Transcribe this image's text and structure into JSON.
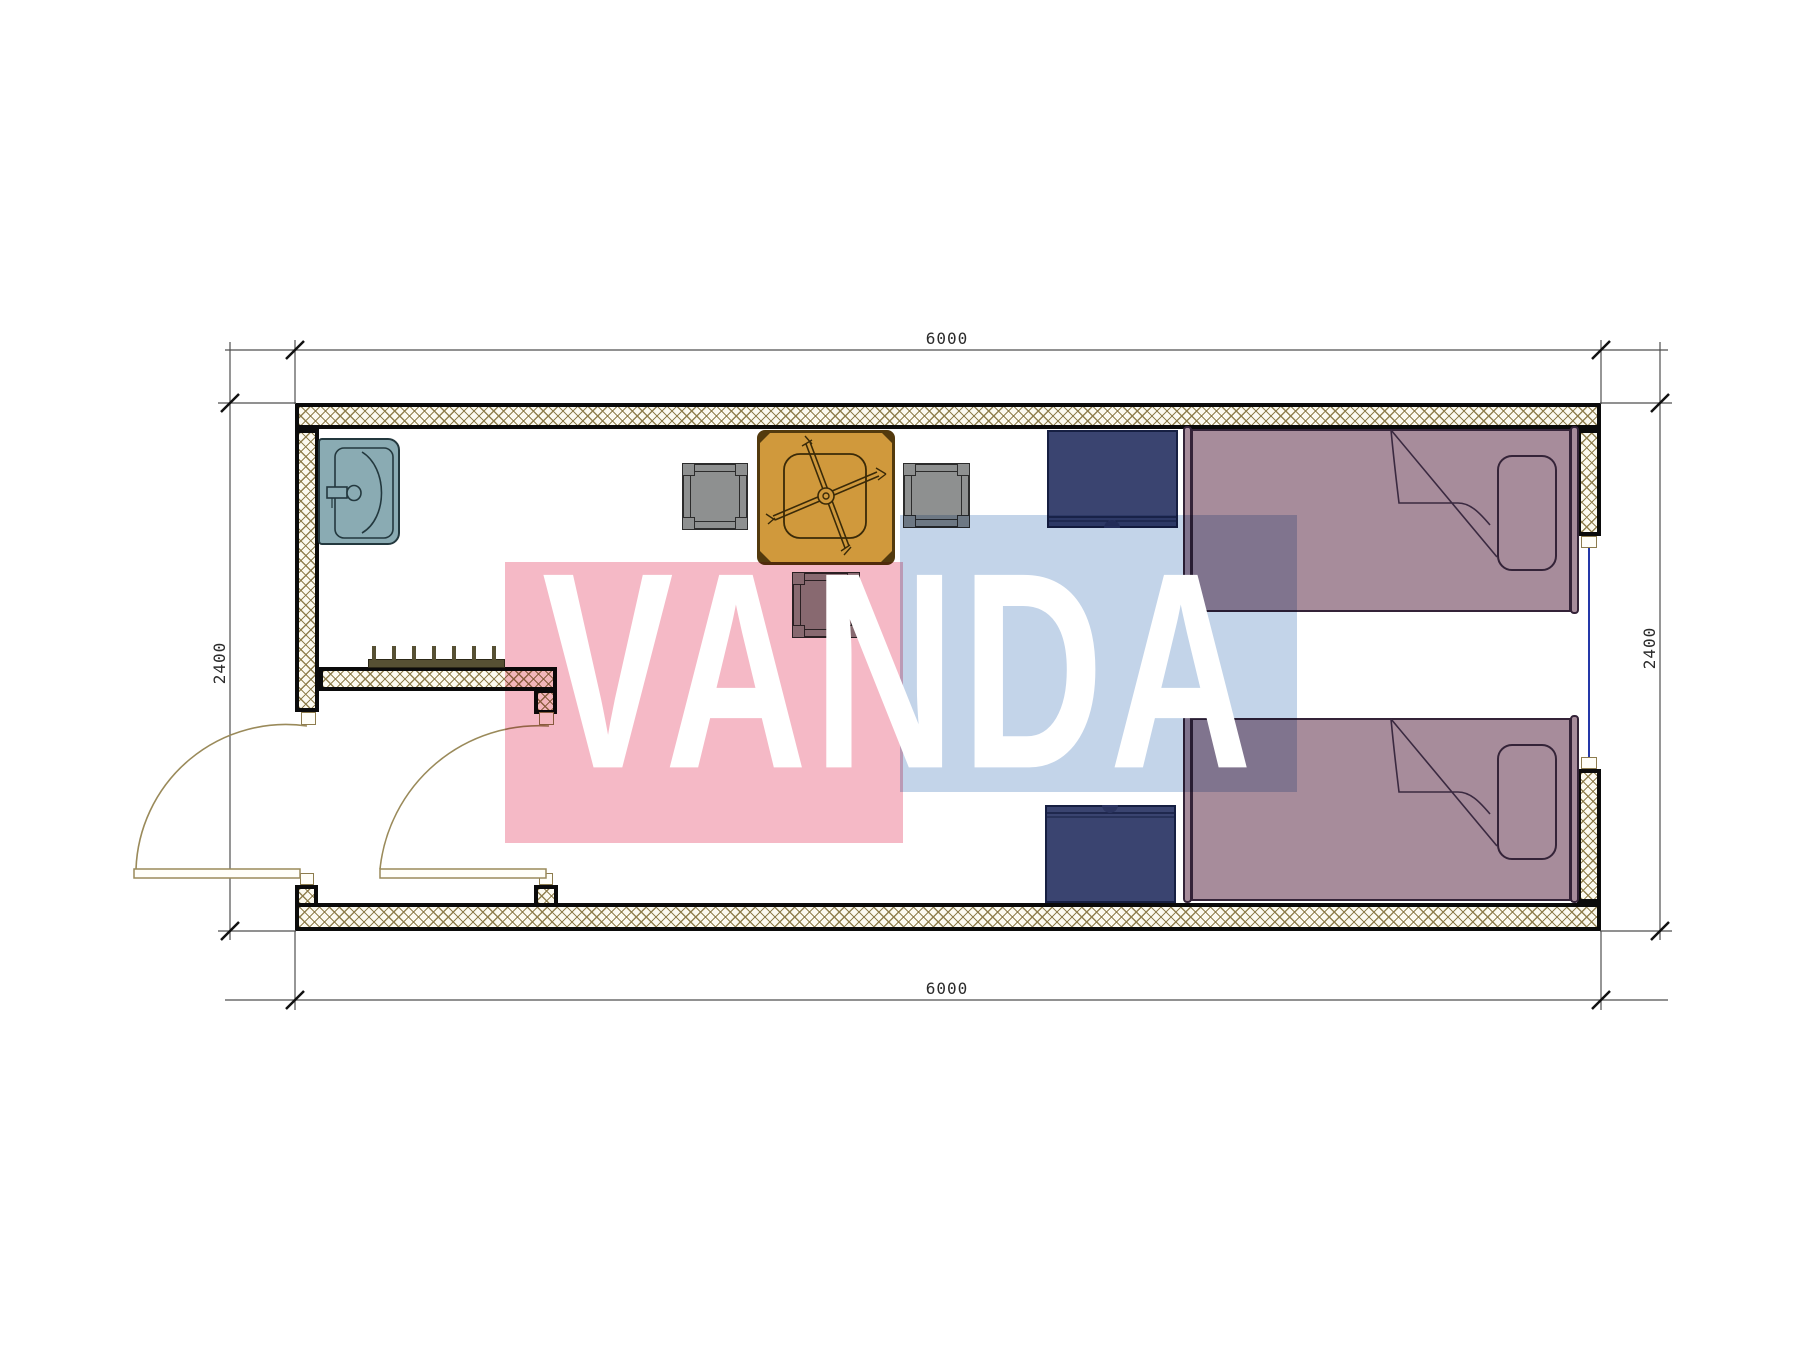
{
  "watermark": {
    "text": "VANDA",
    "pink_color": "#f5b9c6",
    "blue_color": "#c3d4e9",
    "text_color": "#ffffff"
  },
  "dimensions": {
    "top": "6000",
    "bottom": "6000",
    "left": "2400",
    "right": "2400"
  },
  "plan": {
    "type": "floor-plan",
    "room_outer_width_mm": 6000,
    "room_outer_depth_mm": 2400,
    "furniture": [
      {
        "name": "sink",
        "color": "#8aabb3"
      },
      {
        "name": "dining-table",
        "color": "#d0993c"
      },
      {
        "name": "stool-left",
        "color": "#8e9090"
      },
      {
        "name": "stool-right",
        "color": "#8e9090"
      },
      {
        "name": "stool-bottom",
        "color": "#8e9090"
      },
      {
        "name": "nightstand-top",
        "color": "#3a4470"
      },
      {
        "name": "nightstand-bottom",
        "color": "#3a4470"
      },
      {
        "name": "bed-top",
        "color": "#a78c9b"
      },
      {
        "name": "bed-bottom",
        "color": "#a78c9b"
      },
      {
        "name": "coat-rack",
        "color": "#565033"
      },
      {
        "name": "window-right-wall",
        "color": "#2438a8"
      },
      {
        "name": "door-left",
        "color": "#9a8a5a"
      },
      {
        "name": "door-right",
        "color": "#9a8a5a"
      }
    ],
    "colors": {
      "wall_hatch": "#8b7a48",
      "wall_outline": "#0b0b0b",
      "dimension_line": "#4f4f4f",
      "dimension_text": "#2b2b2b"
    }
  }
}
